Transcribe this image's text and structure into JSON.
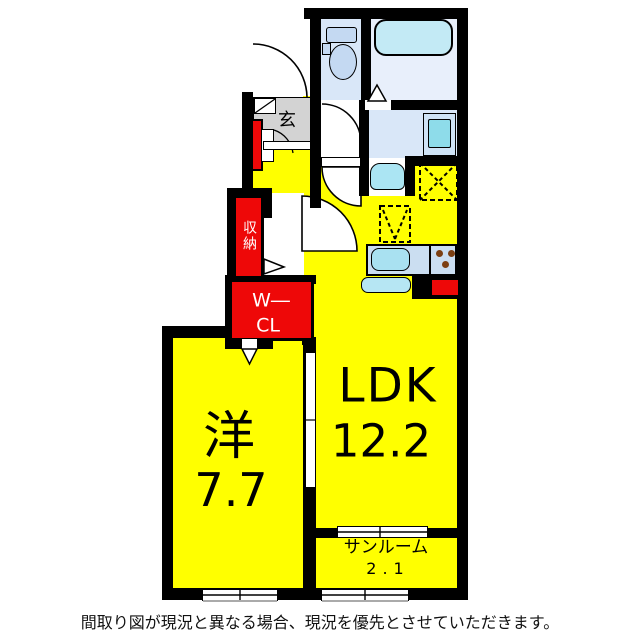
{
  "floorplan": {
    "title_implicit": "apartment floor plan",
    "rooms": {
      "ldk": {
        "label": "LDK",
        "size": "12.2"
      },
      "western_room": {
        "label": "洋",
        "size": "7.7"
      },
      "sunroom": {
        "label": "サンルーム",
        "size": "2.1"
      },
      "entrance": {
        "label": "玄"
      },
      "storage": {
        "label": "収納"
      },
      "walk_in_closet": {
        "line1": "W―",
        "line2": "CL"
      }
    },
    "fixtures": [
      "toilet",
      "bathtub",
      "washbasin",
      "washing-machine",
      "kitchen-sink",
      "stove-burners",
      "refrigerator-space-dashed",
      "hatched-square"
    ],
    "colors": {
      "room_yellow": "#ffff00",
      "accent_red": "#ee0808",
      "wet_floor_blue": "#d9e7f8",
      "bath_floor_blue": "#e8effb",
      "fixture_cyan": "#c3eaf5",
      "entrance_gray": "#d3d3d3",
      "wall_black": "#000000"
    }
  },
  "caption": "間取り図が現況と異なる場合、現況を優先とさせていただきます。"
}
